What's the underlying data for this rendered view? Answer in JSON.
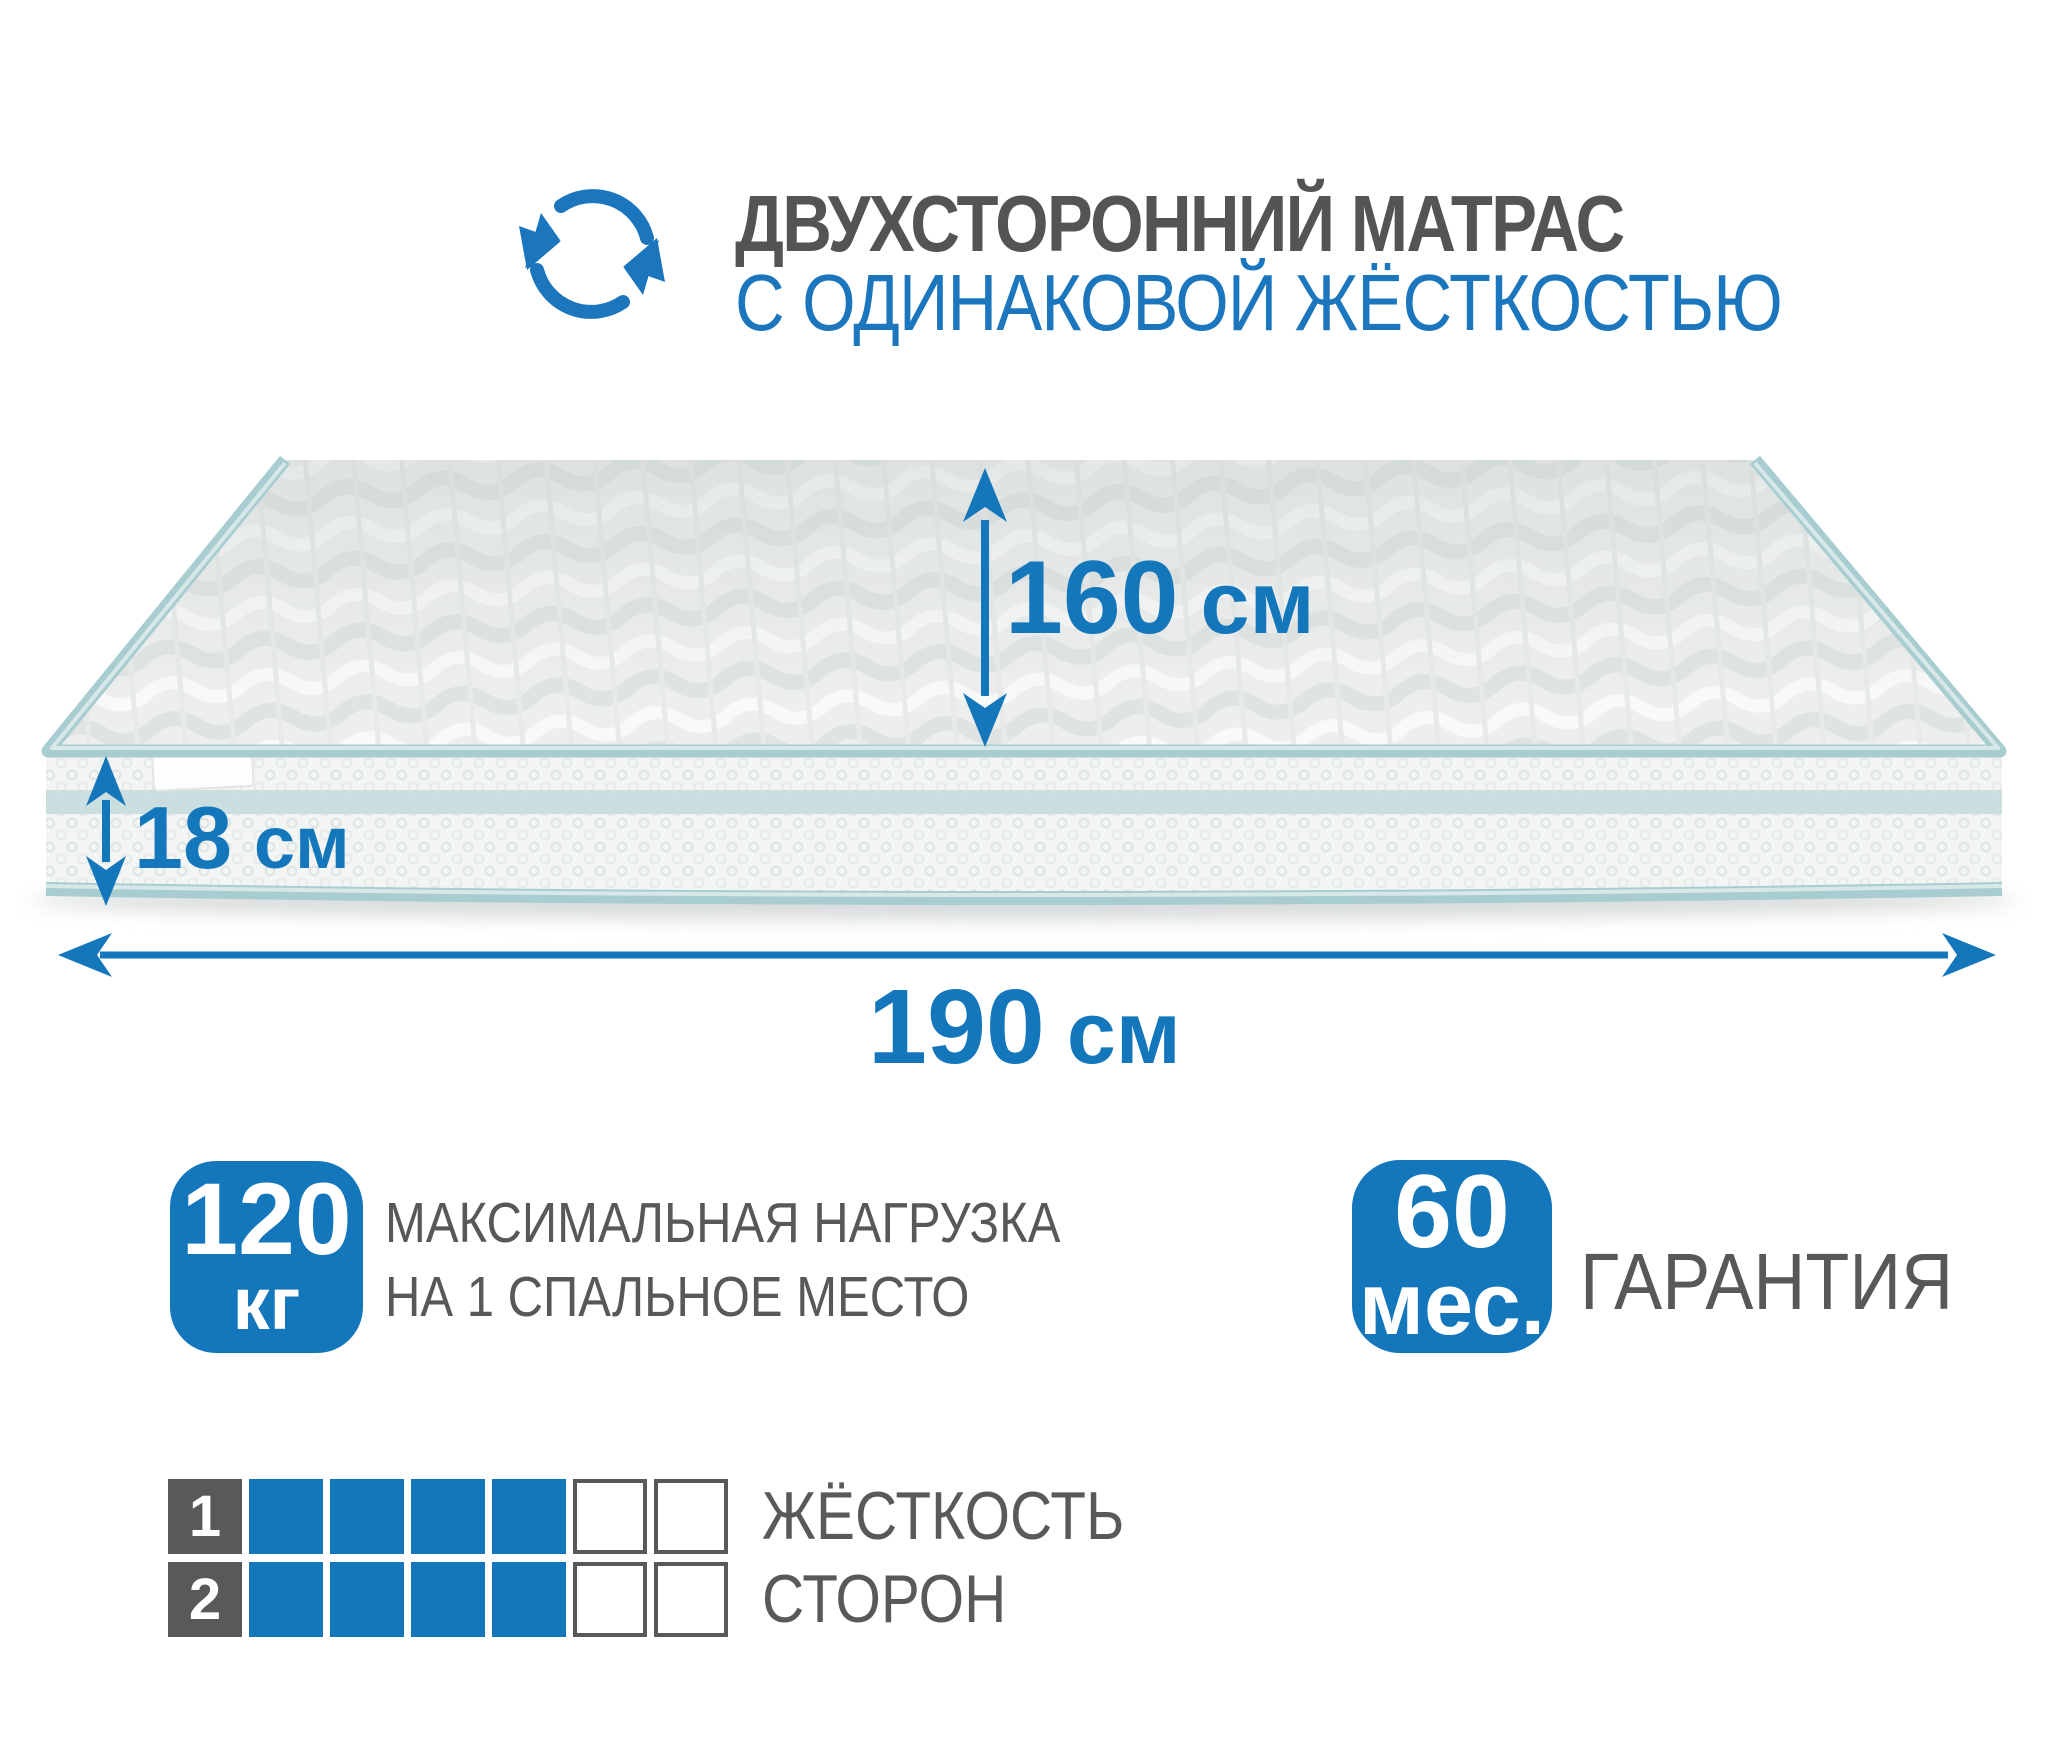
{
  "header": {
    "icon": "rotate-arrows-icon",
    "title_line1": "ДВУХСТОРОННИЙ МАТРАС",
    "title_line2": "С ОДИНАКОВОЙ ЖЁСТКОСТЬЮ"
  },
  "mattress": {
    "dimensions": {
      "depth": {
        "value": "160",
        "unit": "см"
      },
      "height": {
        "value": "18",
        "unit": "см"
      },
      "length": {
        "value": "190",
        "unit": "см"
      }
    }
  },
  "features": {
    "max_load": {
      "value": "120",
      "unit": "кг",
      "label_line1": "МАКСИМАЛЬНАЯ НАГРУЗКА",
      "label_line2": "НА 1 СПАЛЬНОЕ МЕСТО"
    },
    "warranty": {
      "value": "60",
      "unit": "мес.",
      "label": "ГАРАНТИЯ"
    }
  },
  "firmness": {
    "label_line1": "ЖЁСТКОСТЬ",
    "label_line2": "СТОРОН",
    "scale_total": 6,
    "sides": [
      {
        "number": "1",
        "filled": 4
      },
      {
        "number": "2",
        "filled": 4
      }
    ]
  },
  "colors": {
    "accent_blue": "#1477bc",
    "title_gray": "#535456",
    "text_gray": "#58595b",
    "piping_teal": "#a8cdd1"
  }
}
